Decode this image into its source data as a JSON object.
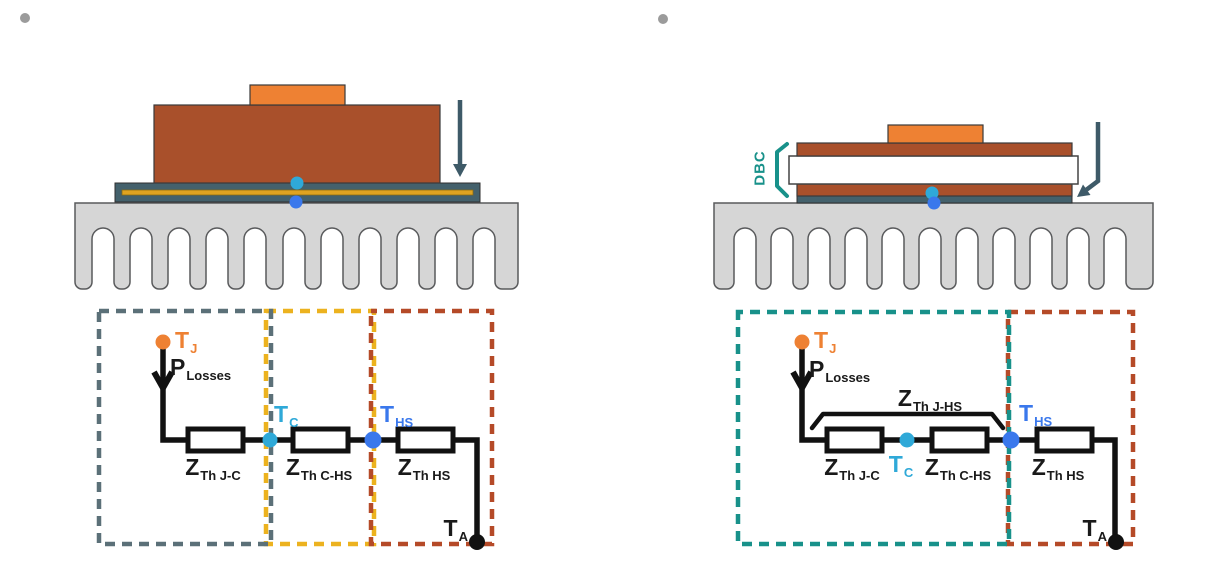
{
  "colors": {
    "orange": "#EE8133",
    "rust": "#A9502B",
    "slate": "#44616C",
    "arrow": "#3E5A68",
    "heatsink": "#D6D6D6",
    "heatsink_outline": "#595A5C",
    "gold": "#DFA321",
    "cyan": "#2FA9D8",
    "blue": "#3A78EC",
    "wire": "#111111",
    "teal": "#18918A",
    "dash_gray": "#5B7078",
    "dash_yellow": "#ECB21F",
    "dash_red": "#B54A28",
    "bullet": "#9B9B9B",
    "white": "#FFFFFF"
  },
  "left": {
    "tj": {
      "t": "T",
      "sub": "J"
    },
    "plosses": {
      "t": "P",
      "sub": "Losses"
    },
    "tc": {
      "t": "T",
      "sub": "C"
    },
    "ths": {
      "t": "T",
      "sub": "HS"
    },
    "ta": {
      "t": "T",
      "sub": "A"
    },
    "z_jc": {
      "t": "Z",
      "sub": "Th J-C"
    },
    "z_chs": {
      "t": "Z",
      "sub": "Th C-HS"
    },
    "z_hs": {
      "t": "Z",
      "sub": "Th HS"
    }
  },
  "right": {
    "dbc": "DBC",
    "tj": {
      "t": "T",
      "sub": "J"
    },
    "plosses": {
      "t": "P",
      "sub": "Losses"
    },
    "z_jhs": {
      "t": "Z",
      "sub": "Th J-HS"
    },
    "tc": {
      "t": "T",
      "sub": "C"
    },
    "ths": {
      "t": "T",
      "sub": "HS"
    },
    "ta": {
      "t": "T",
      "sub": "A"
    },
    "z_jc": {
      "t": "Z",
      "sub": "Th J-C"
    },
    "z_chs": {
      "t": "Z",
      "sub": "Th C-HS"
    },
    "z_hs": {
      "t": "Z",
      "sub": "Th HS"
    }
  }
}
